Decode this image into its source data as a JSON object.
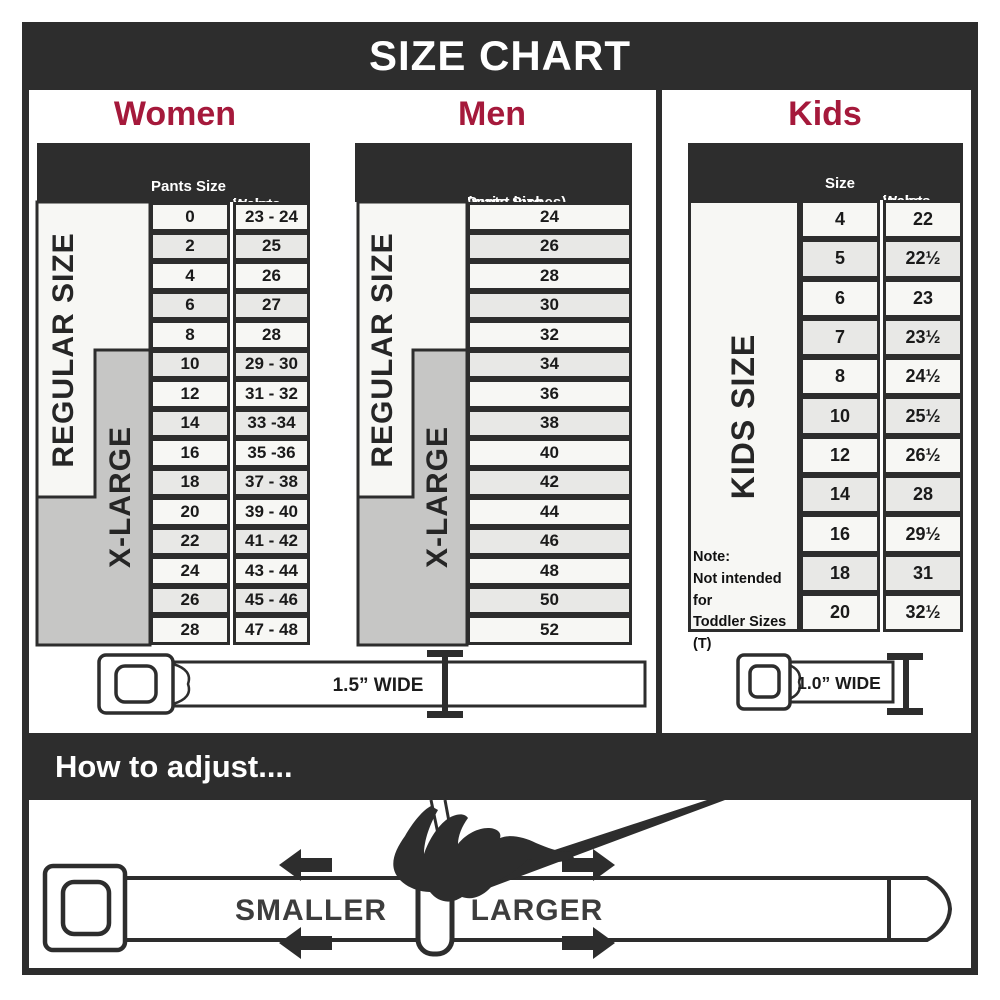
{
  "title": "SIZE CHART",
  "colors": {
    "banner_bg": "#2d2d2d",
    "heading_red": "#a5193b",
    "row_light": "#f7f7f4",
    "row_alt": "#e8e8e6",
    "xlarge_gray": "#c6c6c5",
    "border_ink": "#2d2d2d"
  },
  "women": {
    "heading": "Women",
    "col1_header": "Pants Size",
    "col2_header_line1": "Waist",
    "col2_header_line2": "inches",
    "regular_label": "REGULAR SIZE",
    "xlarge_label": "X-LARGE",
    "rows": [
      {
        "size": "0",
        "waist": "23 - 24"
      },
      {
        "size": "2",
        "waist": "25"
      },
      {
        "size": "4",
        "waist": "26"
      },
      {
        "size": "6",
        "waist": "27"
      },
      {
        "size": "8",
        "waist": "28"
      },
      {
        "size": "10",
        "waist": "29 - 30"
      },
      {
        "size": "12",
        "waist": "31 - 32"
      },
      {
        "size": "14",
        "waist": "33 -34"
      },
      {
        "size": "16",
        "waist": "35 -36"
      },
      {
        "size": "18",
        "waist": "37 - 38"
      },
      {
        "size": "20",
        "waist": "39 - 40"
      },
      {
        "size": "22",
        "waist": "41 - 42"
      },
      {
        "size": "24",
        "waist": "43 - 44"
      },
      {
        "size": "26",
        "waist": "45 - 46"
      },
      {
        "size": "28",
        "waist": "47 - 48"
      }
    ]
  },
  "men": {
    "heading": "Men",
    "header_line1": "Pants Size",
    "header_line2": "(waist inches)",
    "regular_label": "REGULAR SIZE",
    "xlarge_label": "X-LARGE",
    "rows": [
      "24",
      "26",
      "28",
      "30",
      "32",
      "34",
      "36",
      "38",
      "40",
      "42",
      "44",
      "46",
      "48",
      "50",
      "52"
    ]
  },
  "kids": {
    "heading": "Kids",
    "col1_header": "Size",
    "col2_header_line1": "Waist",
    "col2_header_line2": "inches",
    "side_label": "KIDS SIZE",
    "note_line1": "Note:",
    "note_line2": "Not intended for",
    "note_line3": "Toddler Sizes (T)",
    "rows": [
      {
        "size": "4",
        "waist": "22"
      },
      {
        "size": "5",
        "waist": "22½"
      },
      {
        "size": "6",
        "waist": "23"
      },
      {
        "size": "7",
        "waist": "23½"
      },
      {
        "size": "8",
        "waist": "24½"
      },
      {
        "size": "10",
        "waist": "25½"
      },
      {
        "size": "12",
        "waist": "26½"
      },
      {
        "size": "14",
        "waist": "28"
      },
      {
        "size": "16",
        "waist": "29½"
      },
      {
        "size": "18",
        "waist": "31"
      },
      {
        "size": "20",
        "waist": "32½"
      }
    ]
  },
  "belts": {
    "adult_width_label": "1.5” WIDE",
    "kids_width_label": "1.0” WIDE"
  },
  "adjust": {
    "heading": "How to adjust....",
    "smaller_label": "SMALLER",
    "larger_label": "LARGER"
  }
}
